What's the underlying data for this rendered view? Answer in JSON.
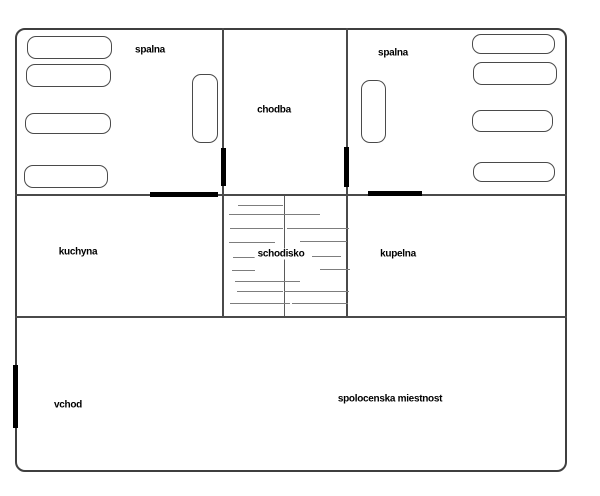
{
  "meta": {
    "kind": "floor-plan",
    "background": "#ffffff"
  },
  "palette": {
    "wall": "#4a4a4a",
    "outer_wall": "#3f3f3f",
    "door": "#000000",
    "step_line": "#7d7d7d",
    "text": "#000000"
  },
  "rooms": {
    "spalna_left": {
      "label": "spalna",
      "x": 150,
      "y": 50
    },
    "spalna_right": {
      "label": "spalna",
      "x": 393,
      "y": 53
    },
    "chodba": {
      "label": "chodba",
      "x": 274,
      "y": 110
    },
    "kuchyna": {
      "label": "kuchyna",
      "x": 78,
      "y": 252
    },
    "schodisko": {
      "label": "schodisko",
      "x": 281,
      "y": 254
    },
    "kupelna": {
      "label": "kupelna",
      "x": 398,
      "y": 254
    },
    "vchod": {
      "label": "vchod",
      "x": 68,
      "y": 405
    },
    "spolocenska_miestnost": {
      "label": "spolocenska miestnost",
      "x": 390,
      "y": 399
    }
  },
  "geometry": {
    "outer": {
      "x": 15,
      "y": 28,
      "w": 552,
      "h": 444
    },
    "walls": [
      {
        "name": "wall-chodba-left",
        "x": 222,
        "y": 28,
        "w": 2,
        "h": 289
      },
      {
        "name": "wall-chodba-right",
        "x": 346,
        "y": 28,
        "w": 2,
        "h": 289
      },
      {
        "name": "wall-first-floor",
        "x": 15,
        "y": 194,
        "w": 552,
        "h": 2
      },
      {
        "name": "wall-ground-floor",
        "x": 15,
        "y": 316,
        "w": 552,
        "h": 2
      }
    ],
    "stair_divider": {
      "name": "staircase-divider",
      "x": 284,
      "y": 196,
      "w": 1,
      "h": 120
    },
    "doors": [
      {
        "name": "door-vchod",
        "x": 13,
        "y": 365,
        "w": 5,
        "h": 63
      },
      {
        "name": "door-spalna-left",
        "x": 221,
        "y": 148,
        "w": 5,
        "h": 38
      },
      {
        "name": "door-spalna-right",
        "x": 344,
        "y": 147,
        "w": 5,
        "h": 40
      },
      {
        "name": "door-kuchyna",
        "x": 150,
        "y": 192,
        "w": 68,
        "h": 5
      },
      {
        "name": "door-kupelna",
        "x": 368,
        "y": 191,
        "w": 54,
        "h": 5
      }
    ],
    "furniture": [
      {
        "name": "bed-left-1",
        "x": 27,
        "y": 36,
        "w": 85,
        "h": 23
      },
      {
        "name": "bed-left-2",
        "x": 26,
        "y": 64,
        "w": 85,
        "h": 23
      },
      {
        "name": "bed-left-3",
        "x": 25,
        "y": 113,
        "w": 86,
        "h": 21
      },
      {
        "name": "bed-left-4",
        "x": 24,
        "y": 165,
        "w": 84,
        "h": 23
      },
      {
        "name": "wardrobe-left",
        "x": 192,
        "y": 74,
        "w": 26,
        "h": 69
      },
      {
        "name": "bed-right-1",
        "x": 472,
        "y": 34,
        "w": 83,
        "h": 20
      },
      {
        "name": "bed-right-2",
        "x": 473,
        "y": 62,
        "w": 84,
        "h": 23
      },
      {
        "name": "bed-right-3",
        "x": 472,
        "y": 110,
        "w": 81,
        "h": 22
      },
      {
        "name": "bed-right-4",
        "x": 473,
        "y": 162,
        "w": 82,
        "h": 20
      },
      {
        "name": "wardrobe-right",
        "x": 361,
        "y": 80,
        "w": 25,
        "h": 63
      }
    ],
    "steps": [
      {
        "y": 205,
        "x1": 238,
        "x2": 283
      },
      {
        "y": 214,
        "x1": 229,
        "x2": 320
      },
      {
        "y": 228,
        "x1": 230,
        "x2": 283
      },
      {
        "y": 228,
        "x1": 287,
        "x2": 349
      },
      {
        "y": 242,
        "x1": 229,
        "x2": 275
      },
      {
        "y": 241,
        "x1": 300,
        "x2": 347
      },
      {
        "y": 257,
        "x1": 233,
        "x2": 256
      },
      {
        "y": 256,
        "x1": 312,
        "x2": 341
      },
      {
        "y": 270,
        "x1": 232,
        "x2": 255
      },
      {
        "y": 269,
        "x1": 320,
        "x2": 350
      },
      {
        "y": 281,
        "x1": 235,
        "x2": 300
      },
      {
        "y": 291,
        "x1": 237,
        "x2": 283
      },
      {
        "y": 291,
        "x1": 284,
        "x2": 349
      },
      {
        "y": 303,
        "x1": 230,
        "x2": 290
      },
      {
        "y": 303,
        "x1": 292,
        "x2": 348
      }
    ]
  }
}
